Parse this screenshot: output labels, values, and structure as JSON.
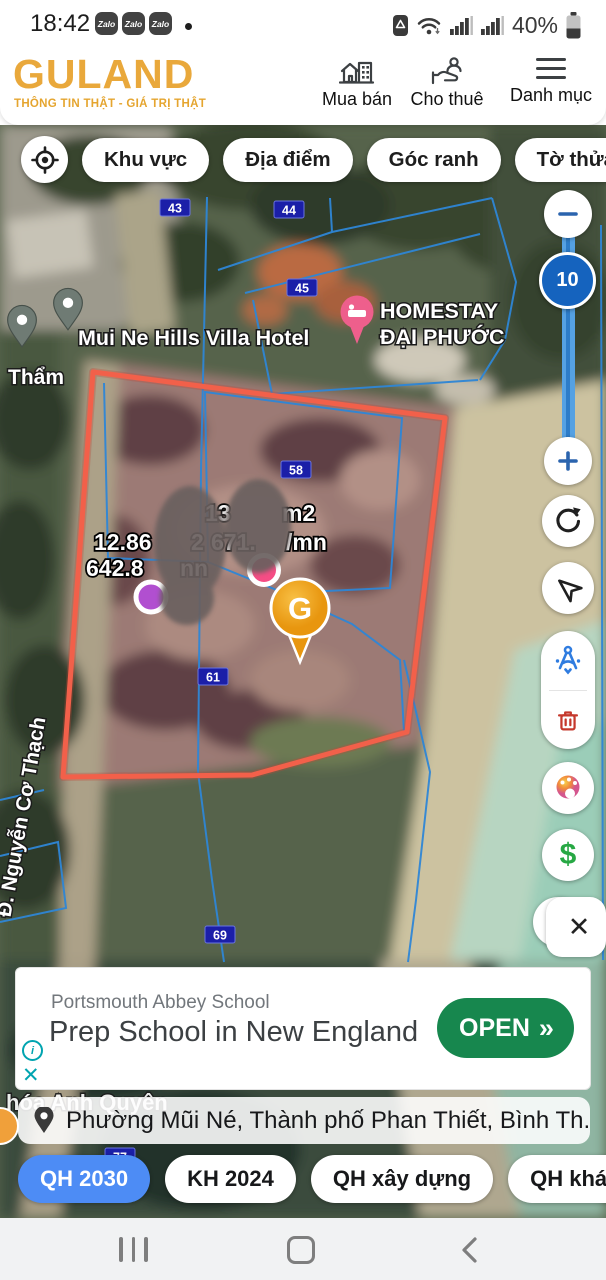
{
  "status_bar": {
    "time": "18:42",
    "zalo_badge": "Zalo",
    "battery": "40%"
  },
  "header": {
    "logo": "GULAND",
    "tagline": "THÔNG TIN THẬT - GIÁ TRỊ THẬT",
    "nav_buy": "Mua bán",
    "nav_rent": "Cho thuê",
    "nav_menu": "Danh mục"
  },
  "filter_chips": {
    "area": "Khu vực",
    "place": "Địa điểm",
    "corner": "Góc ranh",
    "sheet": "Tờ thửa"
  },
  "map": {
    "labels": {
      "hotel": "Mui Ne Hills Villa Hotel",
      "homestay_line1": "HOMESTAY",
      "homestay_line2": "ĐẠI PHƯỚC",
      "tham": "Thẩm",
      "street": "Đ. Nguyễn Cơ Thạch",
      "bottom_place": "hóa Anh Quyên"
    },
    "parcels": {
      "p43": "43",
      "p44": "44",
      "p45": "45",
      "p58": "58",
      "p61": "61",
      "p69": "69",
      "p77": "77"
    },
    "price_left": {
      "l1a": "12.86",
      "l1b": "2",
      "l2a": "642.8",
      "l2b": "nn"
    },
    "price_right": {
      "l1a": "13",
      "l1b": "m2",
      "l2a": "671.",
      "l2b": "/mn"
    },
    "marker_g": "G"
  },
  "map_controls": {
    "zoom_level": "10"
  },
  "ad": {
    "advertiser": "Portsmouth Abbey School",
    "headline": "Prep School in New England",
    "cta": "OPEN",
    "cta_chevrons": "»"
  },
  "location_bar": {
    "text": "Phường Mũi Né, Thành phố Phan Thiết, Bình Th..."
  },
  "layer_chips": {
    "qh2030": "QH 2030",
    "kh2024": "KH 2024",
    "qhxd": "QH xây dựng",
    "qhkhac": "QH khác"
  },
  "colors": {
    "brand_gold": "#E9A83B",
    "boundary_red": "#F2604A",
    "cadastral_blue": "#2E86D6",
    "parcel_badge_blue": "#1B1FA8",
    "zoom_knob_blue": "#1563BE",
    "chip_selected_blue": "#4D8CF5",
    "cta_green": "#17874E",
    "ad_teal": "#00A4B0",
    "dollar_green": "#27A844",
    "trash_red": "#C5382C",
    "measure_blue": "#2F7CE0"
  }
}
